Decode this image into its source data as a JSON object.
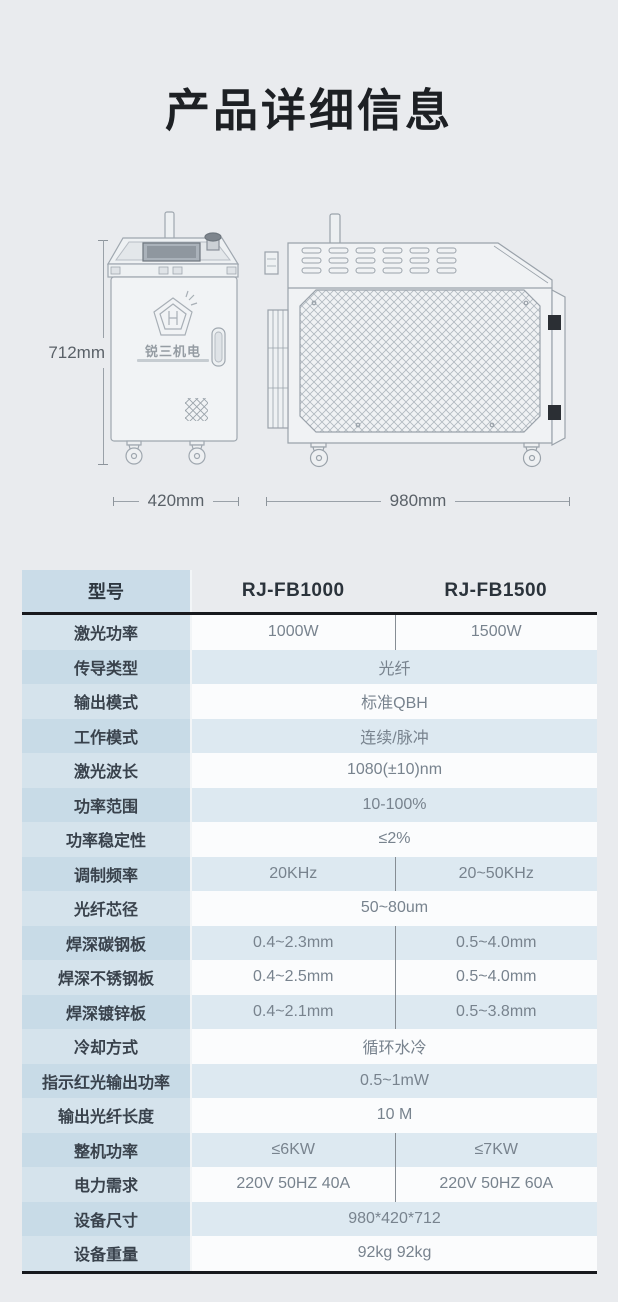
{
  "page": {
    "title": "产品详细信息"
  },
  "diagram": {
    "logo_text": "锐三机电",
    "height_label": "712mm",
    "front_width_label": "420mm",
    "side_width_label": "980mm"
  },
  "table": {
    "header": {
      "label": "型号",
      "model_a": "RJ-FB1000",
      "model_b": "RJ-FB1500"
    },
    "rows": [
      {
        "label": "激光功率",
        "a": "1000W",
        "b": "1500W"
      },
      {
        "label": "传导类型",
        "value": "光纤"
      },
      {
        "label": "输出模式",
        "value": "标准QBH"
      },
      {
        "label": "工作模式",
        "value": "连续/脉冲"
      },
      {
        "label": "激光波长",
        "value": "1080(±10)nm"
      },
      {
        "label": "功率范围",
        "value": "10-100%"
      },
      {
        "label": "功率稳定性",
        "value": "≤2%"
      },
      {
        "label": "调制频率",
        "a": "20KHz",
        "b": "20~50KHz"
      },
      {
        "label": "光纤芯径",
        "value": "50~80um"
      },
      {
        "label": "焊深碳钢板",
        "a": "0.4~2.3mm",
        "b": "0.5~4.0mm"
      },
      {
        "label": "焊深不锈钢板",
        "a": "0.4~2.5mm",
        "b": "0.5~4.0mm"
      },
      {
        "label": "焊深镀锌板",
        "a": "0.4~2.1mm",
        "b": "0.5~3.8mm"
      },
      {
        "label": "冷却方式",
        "value": "循环水冷"
      },
      {
        "label": "指示红光输出功率",
        "value": "0.5~1mW"
      },
      {
        "label": "输出光纤长度",
        "value": "10 M"
      },
      {
        "label": "整机功率",
        "a": "≤6KW",
        "b": "≤7KW"
      },
      {
        "label": "电力需求",
        "a": "220V 50HZ 40A",
        "b": "220V 50HZ 60A"
      },
      {
        "label": "设备尺寸",
        "value": "980*420*712"
      },
      {
        "label": "设备重量",
        "value": "92kg 92kg"
      }
    ]
  },
  "colors": {
    "page_bg": "#e9ebee",
    "row_bg": "#fbfcfd",
    "row_alt_bg": "#dde9f1",
    "label_col_bg": "#c8dbe7",
    "header_label_bg": "#cadce8",
    "divider": "#17191d"
  }
}
